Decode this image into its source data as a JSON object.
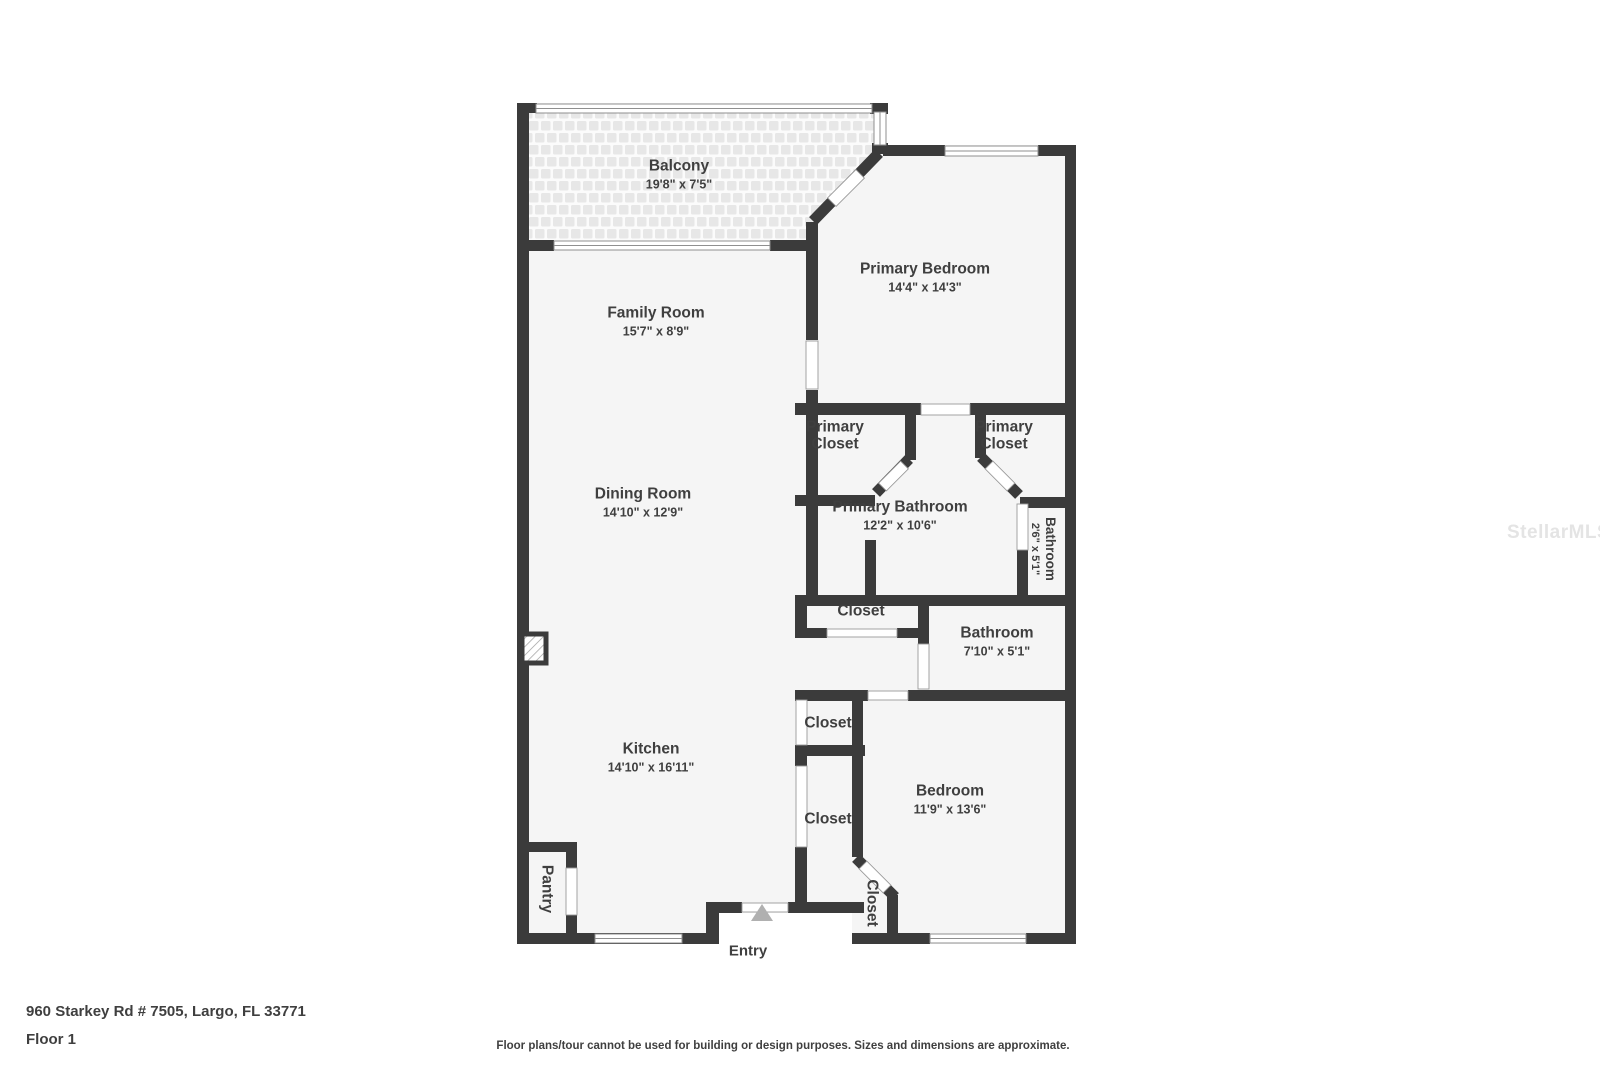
{
  "floorplan": {
    "rooms": {
      "balcony": {
        "name": "Balcony",
        "dims": "19'8\" x 7'5\""
      },
      "family_room": {
        "name": "Family Room",
        "dims": "15'7\" x 8'9\""
      },
      "dining_room": {
        "name": "Dining Room",
        "dims": "14'10\" x 12'9\""
      },
      "kitchen": {
        "name": "Kitchen",
        "dims": "14'10\" x 16'11\""
      },
      "primary_bedroom": {
        "name": "Primary Bedroom",
        "dims": "14'4\" x 14'3\""
      },
      "primary_closet_left": {
        "name": "Primary Closet"
      },
      "primary_closet_right": {
        "name": "Primary Closet"
      },
      "primary_bathroom": {
        "name": "Primary Bathroom",
        "dims": "12'2\" x 10'6\""
      },
      "small_bathroom": {
        "name": "Bathroom",
        "dims": "2'6\" x 5'1\""
      },
      "hall_closet": {
        "name": "Closet"
      },
      "bathroom": {
        "name": "Bathroom",
        "dims": "7'10\" x 5'1\""
      },
      "closet_upper": {
        "name": "Closet"
      },
      "closet_lower": {
        "name": "Closet"
      },
      "bedroom": {
        "name": "Bedroom",
        "dims": "11'9\" x 13'6\""
      },
      "pantry": {
        "name": "Pantry"
      },
      "bedroom_closet": {
        "name": "Closet"
      },
      "entry": {
        "name": "Entry"
      }
    }
  },
  "footer": {
    "address": "960 Starkey Rd # 7505, Largo, FL 33771",
    "floor": "Floor 1",
    "disclaimer": "Floor plans/tour cannot be used for building or design purposes. Sizes and dimensions are approximate."
  },
  "watermark": "StellarMLS",
  "colors": {
    "wall": "#3b3b3b",
    "room_fill": "#f5f5f5",
    "balcony_tile": "#e7e7e7",
    "text": "#3f3f3f",
    "window_stroke": "#8f8f8f",
    "entry_arrow": "#b0b0b0",
    "watermark": "#e4e4e4"
  }
}
